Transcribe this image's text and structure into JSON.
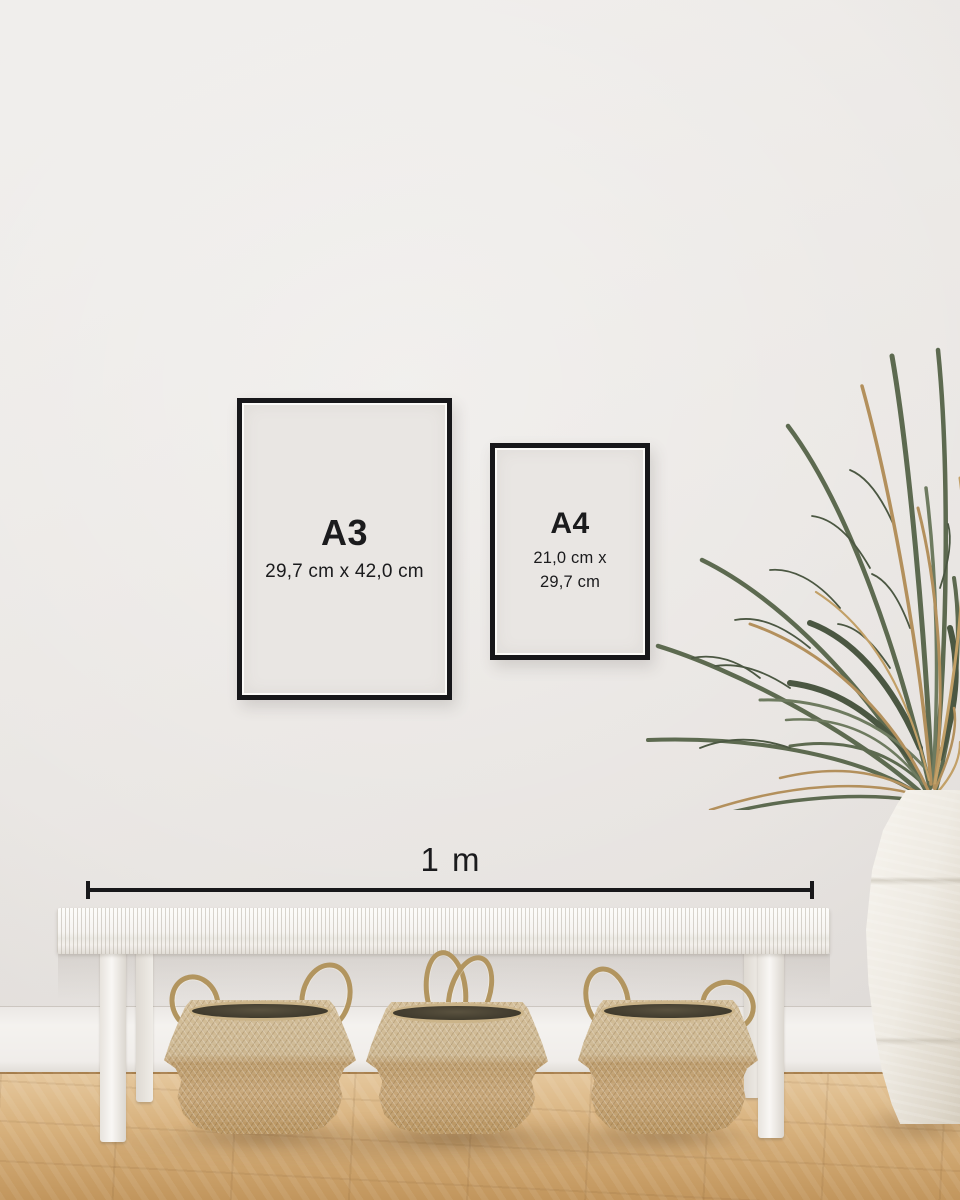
{
  "frames": {
    "a3": {
      "label": "A3",
      "dimensions": "29,7 cm x 42,0 cm"
    },
    "a4": {
      "label": "A4",
      "dimensions_line1": "21,0 cm x",
      "dimensions_line2": "29,7 cm"
    }
  },
  "scale_bar": {
    "label": "1 m"
  },
  "palette": {
    "frame_border": "#17171a",
    "frame_matte": "#e9e6e3",
    "text": "#1b1b1d",
    "wall": "#ebe8e5",
    "baseboard": "#f2f0ed",
    "floor_light": "#e5c79c",
    "floor_dark": "#c1955c",
    "bench_white": "#f6f4f1",
    "basket_light": "#cdb791",
    "basket_dark": "#b8945f",
    "plant_green": "#5d6a50",
    "plant_dried": "#b3905c",
    "vase": "#eeeae2"
  }
}
